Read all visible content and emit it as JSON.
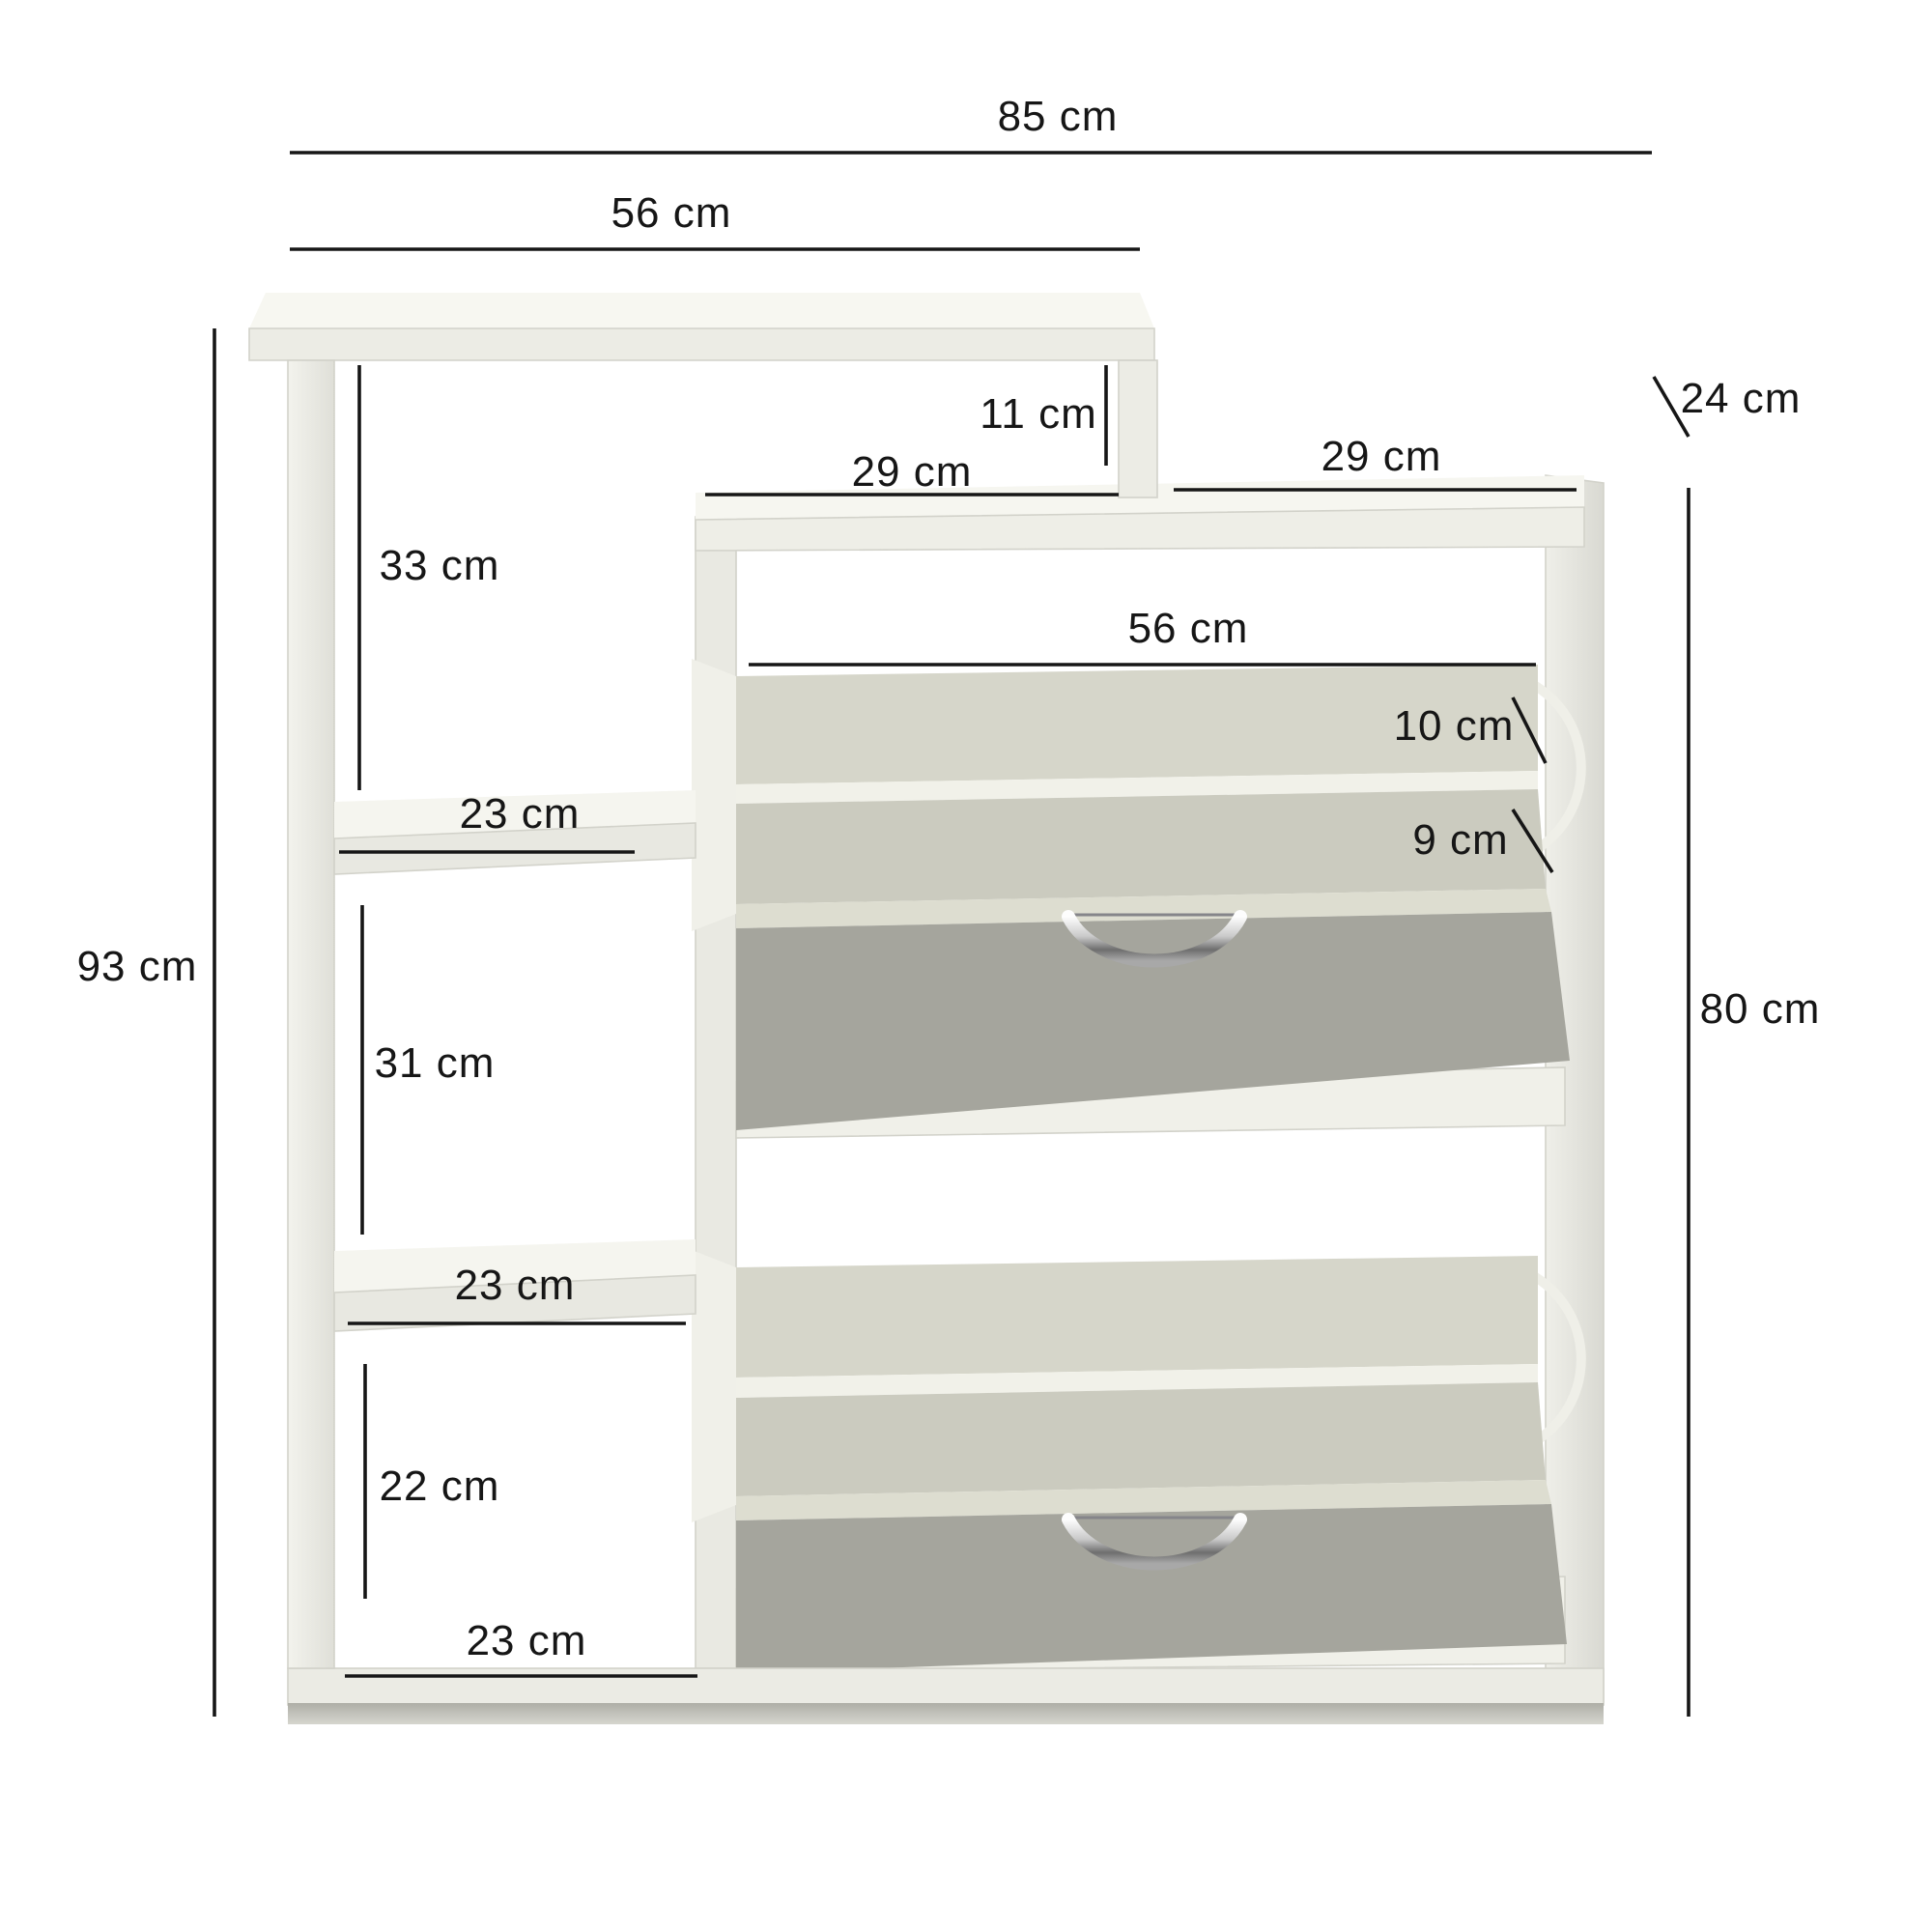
{
  "diagram": {
    "kind": "furniture-dimension-diagram",
    "subject": "shoe cabinet with two tilt-out drawers and open side shelf",
    "unit": "cm",
    "background": "#ffffff"
  },
  "colors": {
    "dimension": "#161616",
    "panel_white": "#f2f2ec",
    "panel_shade": "#e8e8e1",
    "panel_top": "#f7f7f1",
    "interior_back": "#d6d6ca",
    "interior_front": "#cbcbbf",
    "edge_strip": "#ddddd0",
    "flap_front": "#a5a59d",
    "flap_front_dark": "#9b9b93",
    "base_shadow": "#b0b0a8",
    "chrome": "#c9c9c9"
  },
  "dims": {
    "overall_width": "85 cm",
    "top_panel_width": "56 cm",
    "depth": "24 cm",
    "step_gap_height": "11 cm",
    "top_left_half_width": "29 cm",
    "top_right_half_width": "29 cm",
    "upper_compartment_height": "33 cm",
    "flap_opening_width": "56 cm",
    "flap_back_lip_height": "10 cm",
    "flap_front_lip_height": "9 cm",
    "shelf1_depth": "23 cm",
    "left_unit_height": "93 cm",
    "middle_compartment_height": "31 cm",
    "cabinet_height": "80 cm",
    "shelf2_depth": "23 cm",
    "bottom_compartment_height": "22 cm",
    "base_shelf_depth": "23 cm"
  }
}
